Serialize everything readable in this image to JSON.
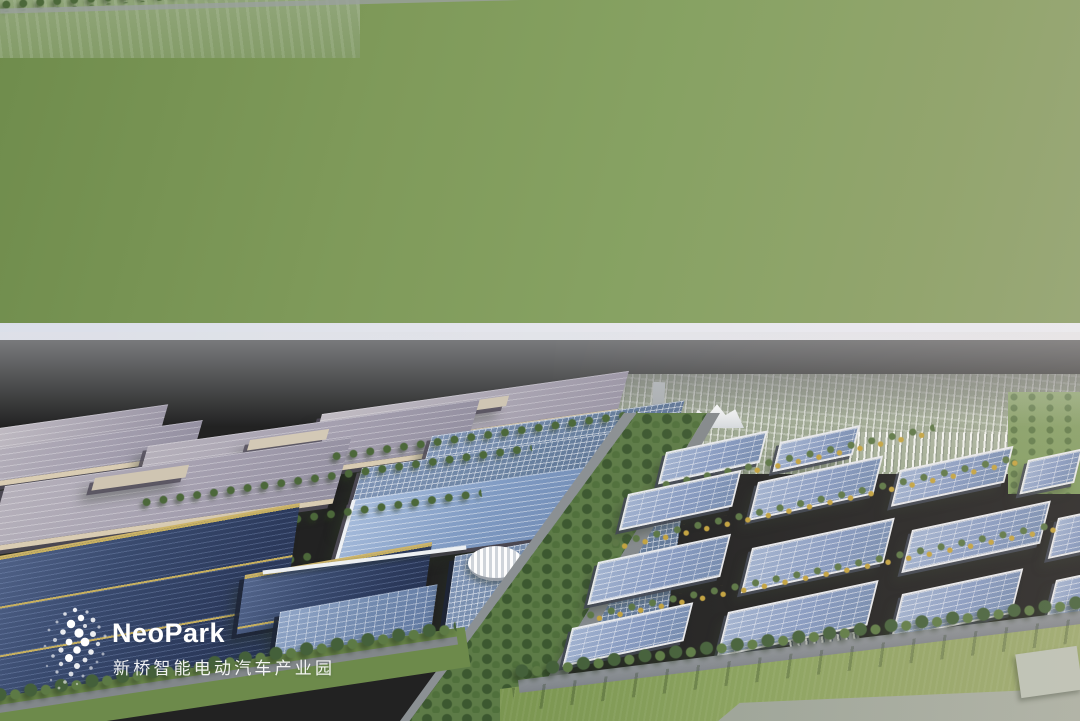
{
  "watermark": {
    "brand": "NeoPark",
    "subtitle": "新桥智能电动汽车产业园"
  },
  "palette": {
    "sky_blue": "#87a6cd",
    "sky_warm": "#f7ece4",
    "horizon_haze": "#dfe1e6",
    "far_field_green": "#8da37d",
    "grass_green": "#86a15c",
    "tree_green": "#4c683a",
    "roof_mauve": "#a39eae",
    "roof_solar_dark": "#2c3a5c",
    "roof_solar_blue": "#8599c0",
    "gold_beam": "#c2a855",
    "wall_beige": "#d9ccb3",
    "road_grey": "#878c90",
    "parapet_white": "#e7e9ed",
    "watermark_text": "#ffffff"
  }
}
